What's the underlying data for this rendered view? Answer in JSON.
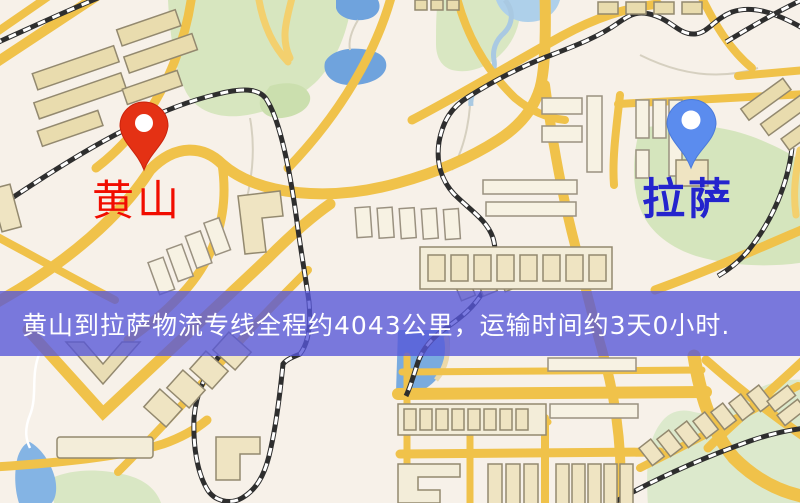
{
  "map": {
    "markers": {
      "origin": {
        "label": "黄山",
        "label_color": "#f10d00",
        "pin_color": "#e43114",
        "icon": "red-pin-icon"
      },
      "destination": {
        "label": "拉萨",
        "label_color": "#2424cd",
        "pin_color": "#5b8cee",
        "icon": "blue-pin-icon"
      }
    },
    "banner": {
      "text": "黄山到拉萨物流专线全程约4043公里，运输时间约3天0小时.",
      "distance_km": "4043",
      "transit_time": "3天0小时",
      "background_color": "#5656d8",
      "text_color": "#ffffff"
    },
    "palette": {
      "background": "#f7f1e9",
      "road": "#f0c24a",
      "railway": "#2e2e2e",
      "water": "#74a8e0",
      "park": "#d7e6bf",
      "building": "#efe4c2"
    }
  }
}
